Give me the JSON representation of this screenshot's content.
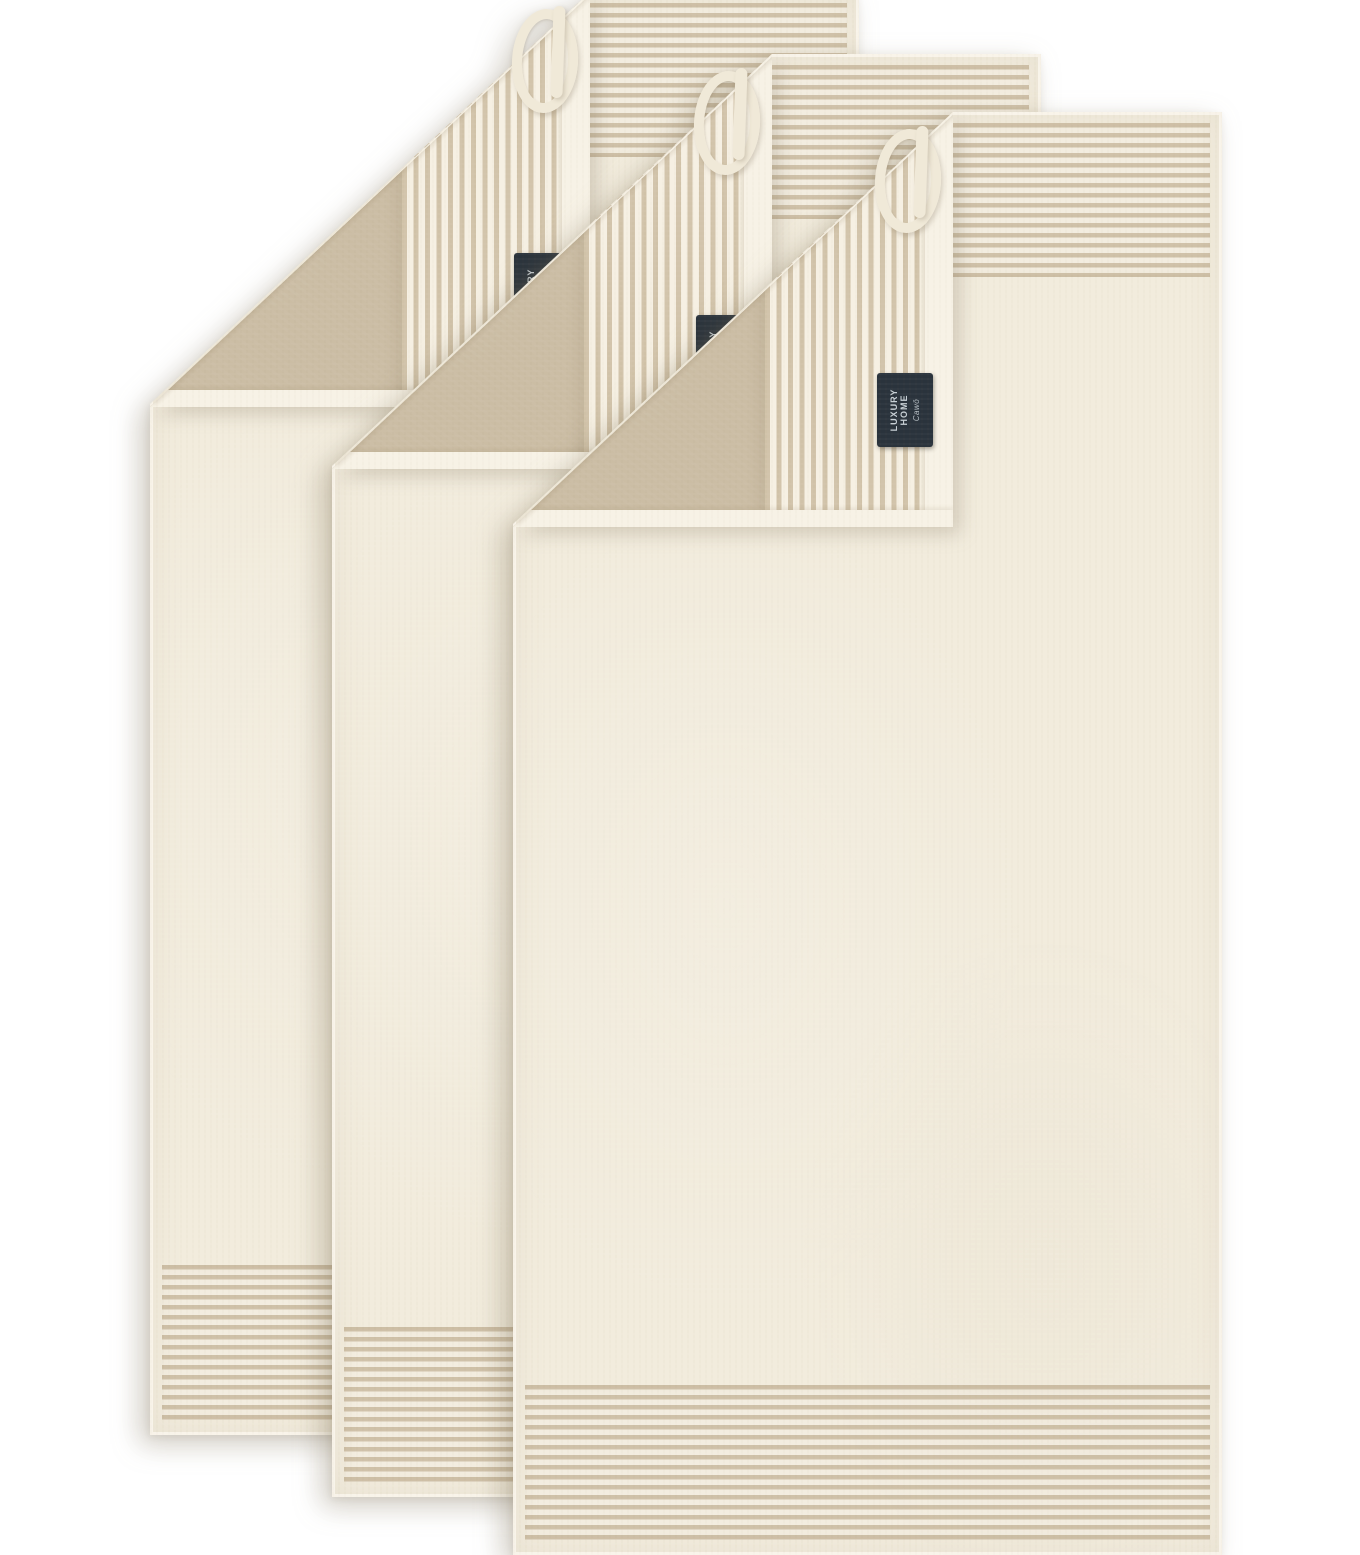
{
  "scene": {
    "type": "product-photo",
    "subject": "Set of 3 cream terry towels with beige woven stripe bands, folded corners showing striped reverse, hanging loops and brand tags",
    "towel_count": 3,
    "background_color": "#ffffff"
  },
  "towels": [
    {
      "id": "back",
      "position": "top-left"
    },
    {
      "id": "middle",
      "position": "center"
    },
    {
      "id": "front",
      "position": "bottom-right"
    }
  ],
  "tag": {
    "line1": "LUXURY",
    "line2": "HOME",
    "brand": "Cawö"
  },
  "colors": {
    "background": "#ffffff",
    "towel_cream": "#f2ecdd",
    "hem_cream": "#f7f2e6",
    "stripe_beige": "#cfc1a8",
    "stripe_gap": "#f3ede0",
    "flap_stripe": "#d2c4ab",
    "flap_stripe_gap": "#f6f0e3",
    "flap_beige": "#cbbda4",
    "loop_cream": "#f0e9d8",
    "tag_navy": "#2a333c",
    "tag_text": "#c8d0d6"
  }
}
